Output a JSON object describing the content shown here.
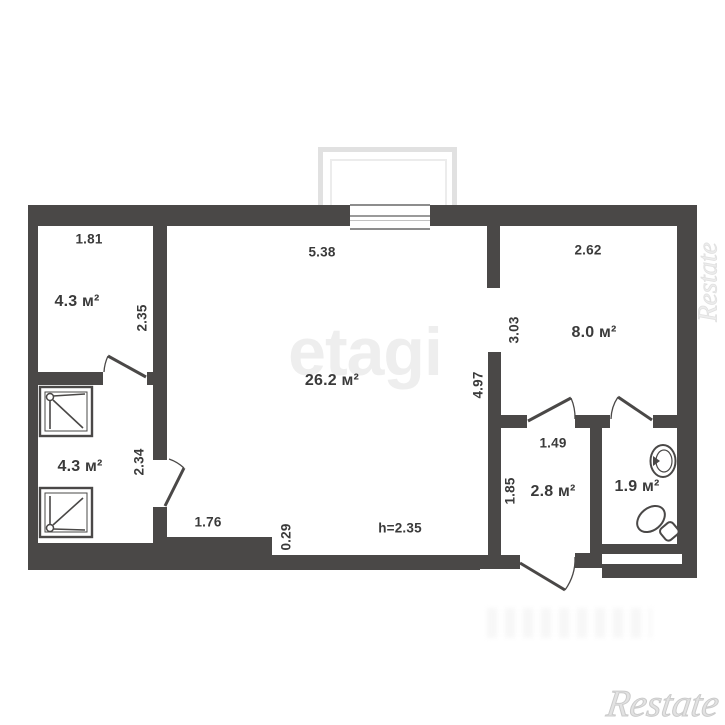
{
  "plan": {
    "rooms": {
      "top_left": {
        "area": "4.3 м²"
      },
      "bottom_left": {
        "area": "4.3 м²"
      },
      "living": {
        "area": "26.2 м²"
      },
      "bedroom": {
        "area": "8.0 м²"
      },
      "hallway": {
        "area": "2.8 м²"
      },
      "wc": {
        "area": "1.9 м²"
      }
    },
    "dimensions": {
      "top_left_width": "1.81",
      "top_left_height": "2.35",
      "living_width": "5.38",
      "living_height": "4.97",
      "living_bottom_width": "1.76",
      "living_step": "0.29",
      "bedroom_width": "2.62",
      "bedroom_height": "3.03",
      "bottom_left_height": "2.34",
      "hallway_width": "1.49",
      "hallway_height": "1.85",
      "ceiling_height": "h=2.35"
    }
  },
  "watermarks": {
    "agency": "etagi",
    "brand": "Restate",
    "brand_side": "Restate"
  },
  "colors": {
    "wall": "#4a4847",
    "text": "#3a3a3a",
    "watermark": "#eeeeee",
    "balcony_outline": "#e1e1e1"
  }
}
